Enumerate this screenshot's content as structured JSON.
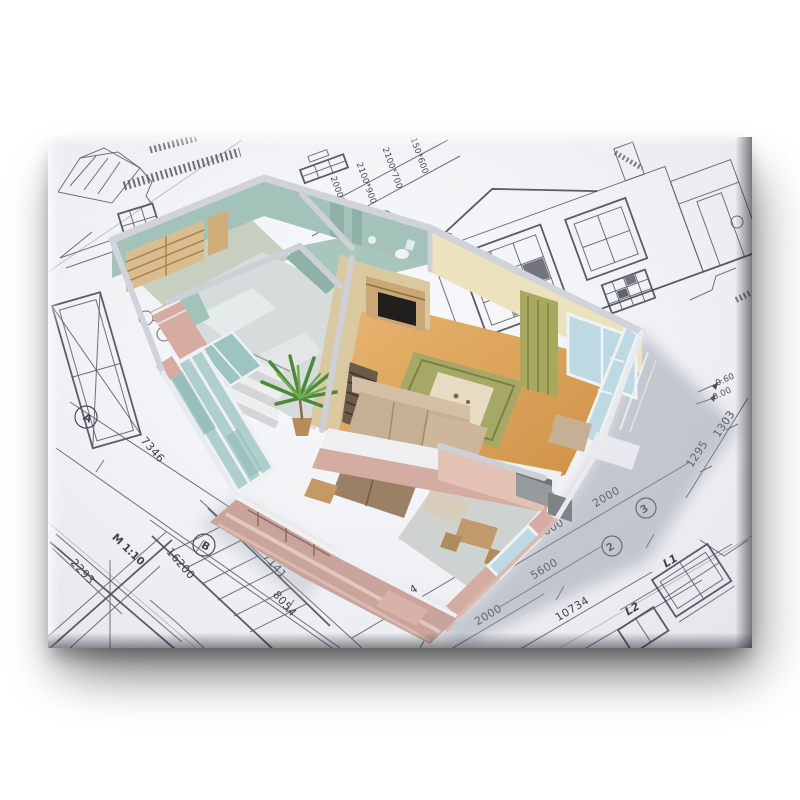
{
  "canvas": {
    "paper_color": "#f3f4f6",
    "line_color": "#4a4f5a",
    "shadow_color": "#1c1c22"
  },
  "house": {
    "colors": {
      "wall_top": "#d0d4da",
      "exterior_pink": "#d6aca2",
      "exterior_pink_light": "#dcb4aa",
      "teal_tile": "#a3c3ba",
      "teal_tile_dark": "#8fb2a8",
      "cream_wall": "#ece2bd",
      "tan_wall": "#d9c8a0",
      "wood_floor": "#dda55c",
      "tile_floor": "#d6dbdb",
      "bath_floor": "#a9c6bd",
      "rug_green": "#a6a868",
      "sofa_tan": "#c6b094",
      "sofa_tan_light": "#d4bfa4",
      "sofa_brown": "#9b8065",
      "glass_blue": "#bcd9e4",
      "glass_teal": "#aecfcd",
      "curtain_olive": "#a8a95e",
      "plant_green": "#4c8a39",
      "wood_furniture": "#d9bd8e",
      "wood_unit": "#c9a875",
      "terrace_pink": "#c9a49c",
      "appliance_gray": "#969c9e",
      "tv_black": "#211f1e",
      "kitchen_floor": "#ced3d2",
      "slat_door": "#6b5b4a"
    }
  },
  "blueprint": {
    "scale_label": "M 1:10",
    "dims": {
      "d7346": "7346",
      "d16200": "16200",
      "d8054": "8054",
      "d7141": "7141",
      "d2293": "2293",
      "d3734": "3734",
      "d2000a": "2000",
      "d10734": "10734",
      "d5600": "5600",
      "d7000": "7000",
      "d2000b": "2000",
      "d1295": "1295",
      "d1303": "1303"
    },
    "levels": {
      "upper": "0.60",
      "lower": "0.00"
    },
    "window_specs": {
      "s1": "2000*900",
      "s2": "2100*900",
      "s3": "2100*700",
      "s4": "2150*600"
    },
    "axis_markers": {
      "a": "A",
      "b": "B",
      "n1": "1",
      "n2": "2",
      "n3": "3"
    },
    "line_labels": {
      "l1": "L1",
      "l2": "L2"
    }
  }
}
